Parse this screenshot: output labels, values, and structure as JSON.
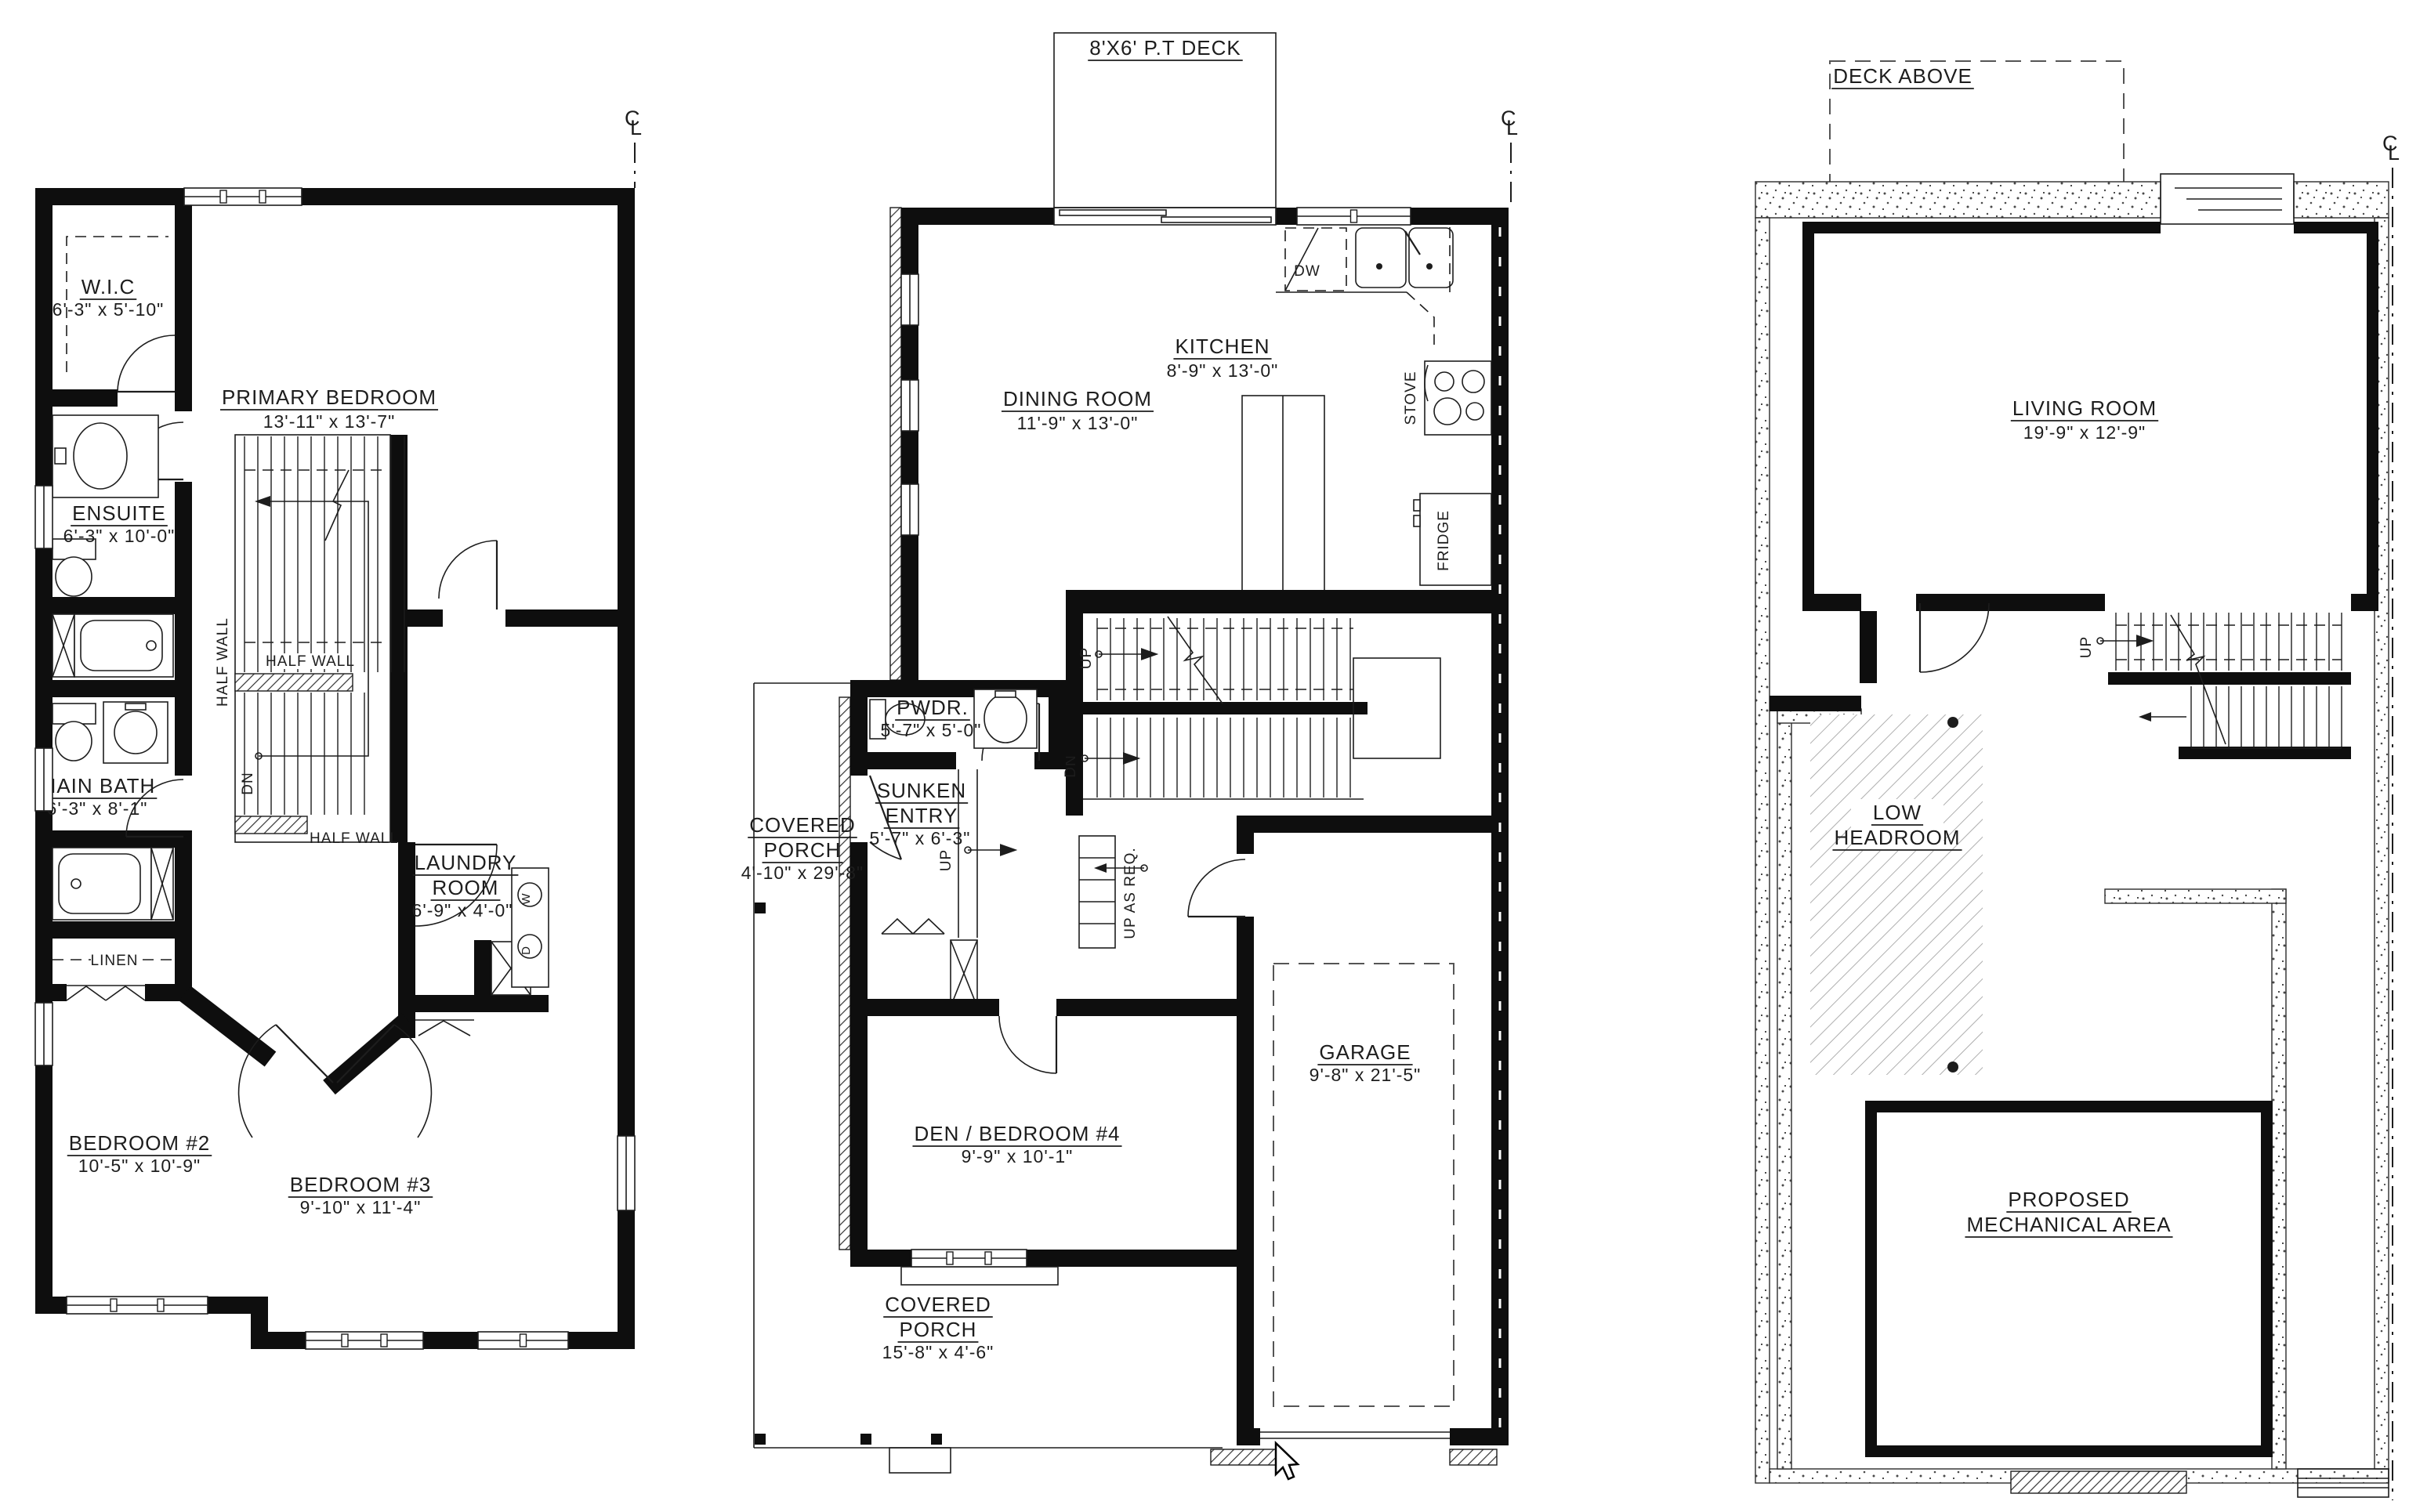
{
  "drawing": {
    "ink_color": "#1d1d1d",
    "background_color": "#ffffff",
    "centerline": {
      "c": "C",
      "l": "L"
    },
    "plans": {
      "second": {
        "rooms": [
          {
            "name": "W.I.C",
            "dims": "6'-3\" x 5'-10\""
          },
          {
            "name": "PRIMARY BEDROOM",
            "dims": "13'-11\" x 13'-7\""
          },
          {
            "name": "ENSUITE",
            "dims": "6'-3\" x 10'-0\""
          },
          {
            "name": "MAIN BATH",
            "dims": "6'-3\" x 8'-1\""
          },
          {
            "name": "LAUNDRY",
            "name2": "ROOM",
            "dims": "6'-9\" x 4'-0\""
          },
          {
            "name": "BEDROOM #2",
            "dims": "10'-5\" x 10'-9\""
          },
          {
            "name": "BEDROOM #3",
            "dims": "9'-10\" x 11'-4\""
          }
        ],
        "labels": {
          "half_wall": "HALF WALL",
          "dn": "DN",
          "linen": "LINEN",
          "washer": "W",
          "dryer": "D"
        }
      },
      "main": {
        "deck": "8'X6' P.T DECK",
        "rooms": [
          {
            "name": "DINING ROOM",
            "dims": "11'-9\" x 13'-0\""
          },
          {
            "name": "KITCHEN",
            "dims": "8'-9\" x 13'-0\""
          },
          {
            "name": "PWDR.",
            "dims": "5'-7\" x 5'-0\""
          },
          {
            "name": "SUNKEN",
            "name2": "ENTRY",
            "dims": "5'-7\" x 6'-3\""
          },
          {
            "name": "COVERED",
            "name2": "PORCH",
            "dims": "4'-10\" x 29'-8\""
          },
          {
            "name": "DEN / BEDROOM #4",
            "dims": "9'-9\" x 10'-1\""
          },
          {
            "name": "GARAGE",
            "dims": "9'-8\" x 21'-5\""
          },
          {
            "name": "COVERED",
            "name2": "PORCH",
            "dims": "15'-8\" x 4'-6\""
          }
        ],
        "labels": {
          "dw": "DW",
          "stove": "STOVE",
          "fridge": "FRIDGE",
          "up": "UP",
          "dn": "DN",
          "up_as_req": "UP AS REQ."
        }
      },
      "basement": {
        "rooms": [
          {
            "name": "LIVING ROOM",
            "dims": "19'-9\" x 12'-9\""
          }
        ],
        "labels": {
          "deck_above": "DECK ABOVE",
          "low1": "LOW",
          "low2": "HEADROOM",
          "mech1": "PROPOSED",
          "mech2": "MECHANICAL AREA",
          "up": "UP"
        }
      }
    }
  }
}
